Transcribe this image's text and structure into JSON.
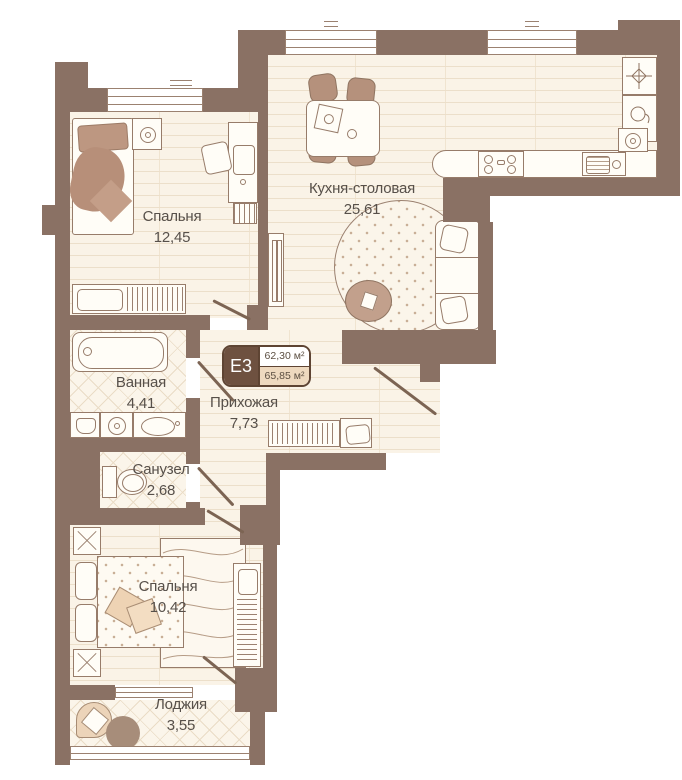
{
  "badge": {
    "code": "E3",
    "area_living": "62,30 м²",
    "area_total": "65,85 м²"
  },
  "rooms": [
    {
      "key": "bedroom1",
      "name": "Спальня",
      "area": "12,45"
    },
    {
      "key": "kitchen",
      "name": "Кухня-столовая",
      "area": "25,61"
    },
    {
      "key": "bathroom",
      "name": "Ванная",
      "area": "4,41"
    },
    {
      "key": "hallway",
      "name": "Прихожая",
      "area": "7,73"
    },
    {
      "key": "wc",
      "name": "Санузел",
      "area": "2,68"
    },
    {
      "key": "bedroom2",
      "name": "Спальня",
      "area": "10,42"
    },
    {
      "key": "loggia",
      "name": "Лоджия",
      "area": "3,55"
    }
  ],
  "colors": {
    "wall": "#8a7164",
    "floor": "#faf3e7",
    "floor_line": "#ecdfca",
    "accent_tan": "#b5917c",
    "badge_dark": "#6e5140",
    "badge_tan": "#eed9bf",
    "badge_border": "#5e4433",
    "text": "#57504a",
    "outline": "#977c6a"
  }
}
